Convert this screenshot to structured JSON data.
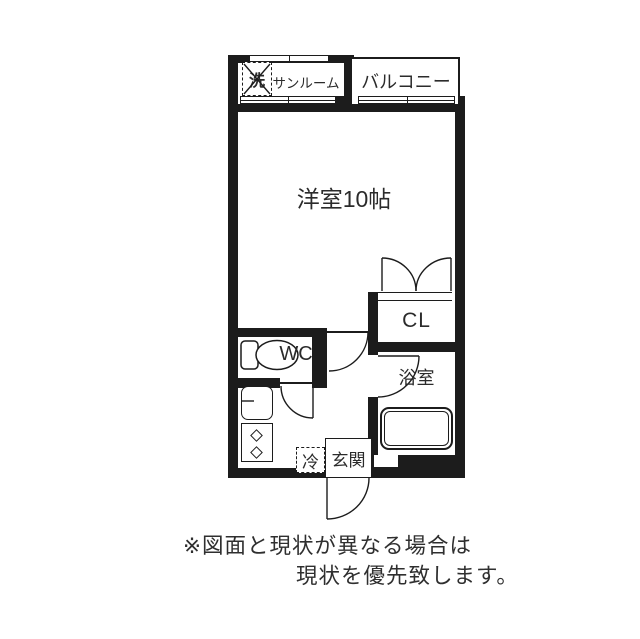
{
  "plan": {
    "labels": {
      "washer": "洗",
      "sunroom": "サンルーム",
      "balcony": "バルコニー",
      "main_room": "洋室10帖",
      "closet": "CL",
      "wc": "WC",
      "bathroom": "浴室",
      "refrigerator": "冷",
      "entrance": "玄関"
    },
    "disclaimer": {
      "line1": "※図面と現状が異なる場合は",
      "line2": "現状を優先致します。"
    },
    "colors": {
      "wall": "#1c1c1c",
      "background": "#ffffff"
    }
  }
}
